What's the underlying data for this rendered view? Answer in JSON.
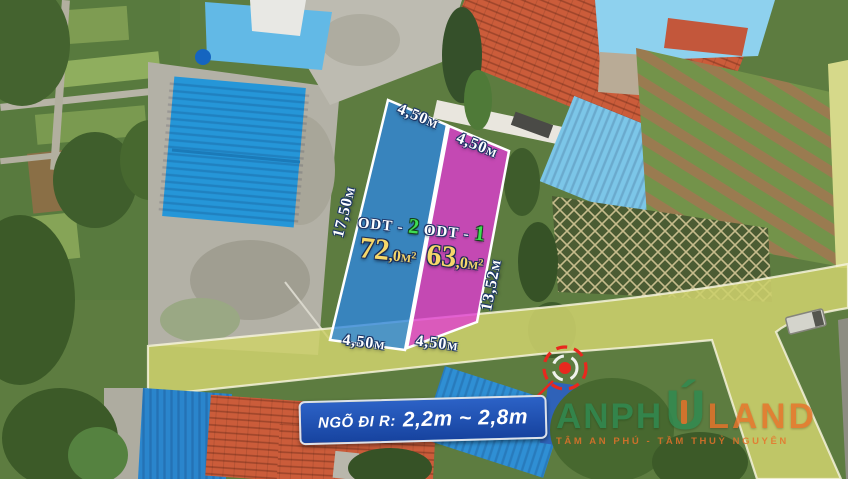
{
  "plots": [
    {
      "code_label": "ODT -",
      "code_number": "2",
      "area_main": "72",
      "area_decimal": ",0m²",
      "width_top": "4,50m",
      "width_bottom": "4,50m",
      "depth": "17,50m",
      "overlay_color": "#2e86e0"
    },
    {
      "code_label": "ODT -",
      "code_number": "1",
      "area_main": "63",
      "area_decimal": ",0m²",
      "width_top": "4,50m",
      "width_bottom": "4,50m",
      "depth": "13,52m",
      "overlay_color": "#e13bd4"
    }
  ],
  "road_sign": {
    "prefix": "NGÕ ĐI R:",
    "range": "2,2m ~ 2,8m",
    "bg_color": "#1e4fb0",
    "text_color": "#ffffff"
  },
  "watermark": {
    "brand_part1": "ANPH",
    "brand_u": "Ú",
    "brand_part2": "LAND",
    "tagline": "TÂM AN PHÚ - TẦM THUỶ NGUYÊN",
    "orange": "#e8722a",
    "green": "#2f8b52"
  },
  "colors": {
    "plot_blue": "#2e86e0",
    "plot_pink": "#e13bd4",
    "dimension_text": "#ffffff",
    "area_text": "#f6d76a",
    "code_number_green": "#3fdc52",
    "road_overlay_yellow": "#cdd06c",
    "target_red": "#e8281e"
  }
}
